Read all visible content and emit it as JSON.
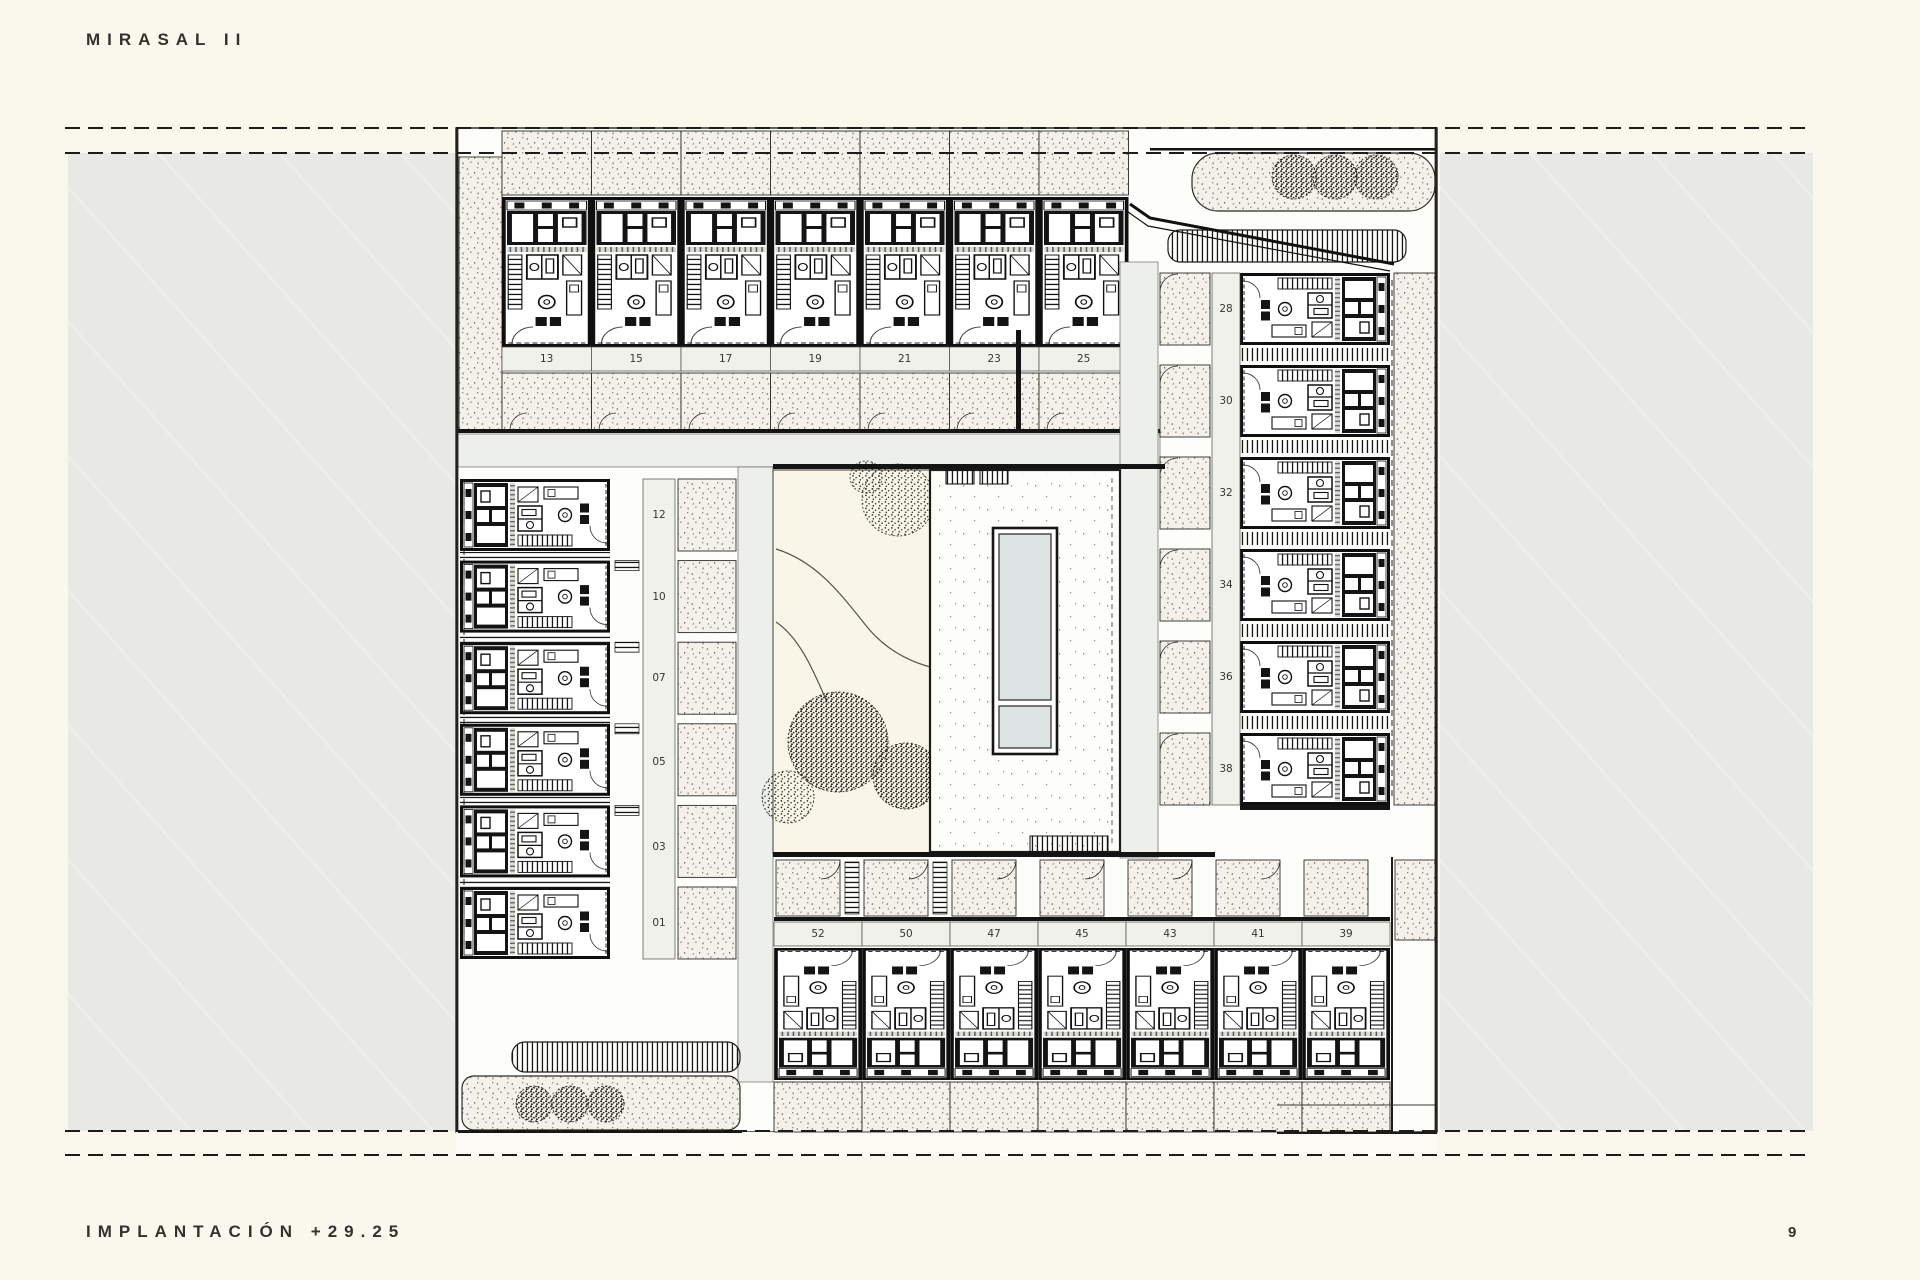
{
  "header": {
    "title": "MIRASAL II"
  },
  "footer": {
    "caption": "IMPLANTACIÓN +29.25",
    "page_number": "9"
  },
  "plan": {
    "description": "site plan level +29.25 with housing units around central pool courtyard",
    "top_row_units": [
      "13",
      "15",
      "17",
      "19",
      "21",
      "23",
      "25"
    ],
    "left_column_units": [
      "12",
      "10",
      "07",
      "05",
      "03",
      "01"
    ],
    "right_column_units": [
      "28",
      "30",
      "32",
      "34",
      "36",
      "38"
    ],
    "bottom_row_units": [
      "52",
      "50",
      "47",
      "45",
      "43",
      "41",
      "39"
    ]
  },
  "colors": {
    "page_bg": "#faf8ed",
    "panel_gray": "#e8e8e5",
    "plan_bg": "#fdfdfa",
    "stipple_bg": "#f3f1ea",
    "garden_bg": "#f9f6e7",
    "pool_water": "#dde4e3",
    "corridor_gray": "#edefeb",
    "cell_gray": "#f1f1ec",
    "ink": "#141414"
  }
}
